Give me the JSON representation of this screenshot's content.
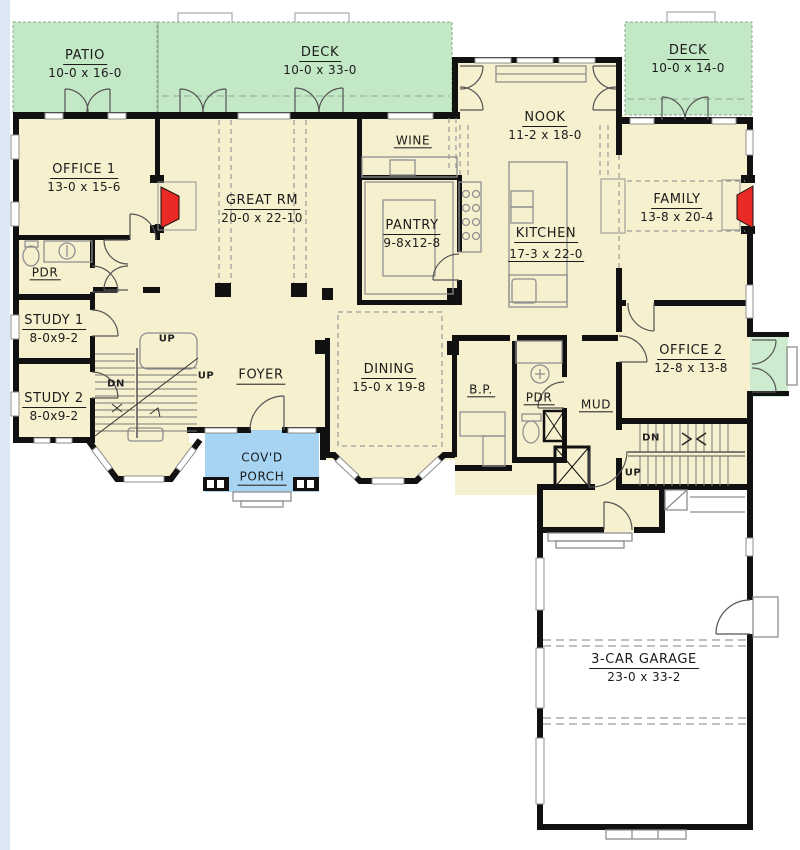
{
  "plan": {
    "type": "floor-plan-main-level",
    "colors": {
      "walls": "#111111",
      "room_floor": "#f7f0cf",
      "outdoor_green": "#c3e8c5",
      "porch_blue": "#a6d4f2",
      "fireplace_red": "#ea2a24",
      "garage_floor": "#ffffff",
      "line_gray": "#8f8f8f",
      "page_edge": "#dce8f5"
    },
    "rooms": [
      {
        "key": "patio",
        "label": "PATIO",
        "dims": "10-0 x 16-0"
      },
      {
        "key": "deck-main",
        "label": "DECK",
        "dims": "10-0 x 33-0"
      },
      {
        "key": "deck-right",
        "label": "DECK",
        "dims": "10-0 x 14-0"
      },
      {
        "key": "office-1",
        "label": "OFFICE 1",
        "dims": "13-0 x 15-6"
      },
      {
        "key": "great-rm",
        "label": "GREAT RM",
        "dims": "20-0 x 22-10"
      },
      {
        "key": "nook",
        "label": "NOOK",
        "dims": "11-2 x 18-0"
      },
      {
        "key": "family",
        "label": "FAMILY",
        "dims": "13-8 x 20-4"
      },
      {
        "key": "wine",
        "label": "WINE",
        "dims": ""
      },
      {
        "key": "pantry",
        "label": "PANTRY",
        "dims": "9-8x12-8"
      },
      {
        "key": "kitchen",
        "label": "KITCHEN",
        "dims": "17-3 x 22-0"
      },
      {
        "key": "pdr-1",
        "label": "PDR",
        "dims": ""
      },
      {
        "key": "study-1",
        "label": "STUDY 1",
        "dims": "8-0x9-2"
      },
      {
        "key": "study-2",
        "label": "STUDY 2",
        "dims": "8-0x9-2"
      },
      {
        "key": "foyer",
        "label": "FOYER",
        "dims": ""
      },
      {
        "key": "dining",
        "label": "DINING",
        "dims": "15-0 x 19-8"
      },
      {
        "key": "butlers-pantry",
        "label": "B.P.",
        "dims": ""
      },
      {
        "key": "pdr-2",
        "label": "PDR",
        "dims": ""
      },
      {
        "key": "mud",
        "label": "MUD",
        "dims": ""
      },
      {
        "key": "office-2",
        "label": "OFFICE 2",
        "dims": "12-8 x 13-8"
      },
      {
        "key": "covd-porch",
        "label": "COV'D",
        "label2": "PORCH",
        "dims": ""
      },
      {
        "key": "garage",
        "label": "3-CAR GARAGE",
        "dims": "23-0 x 33-2"
      }
    ],
    "stair_labels": {
      "front_up_upper": "UP",
      "front_up_lower": "UP",
      "front_dn": "DN",
      "back_dn": "DN",
      "back_up": "UP"
    }
  }
}
